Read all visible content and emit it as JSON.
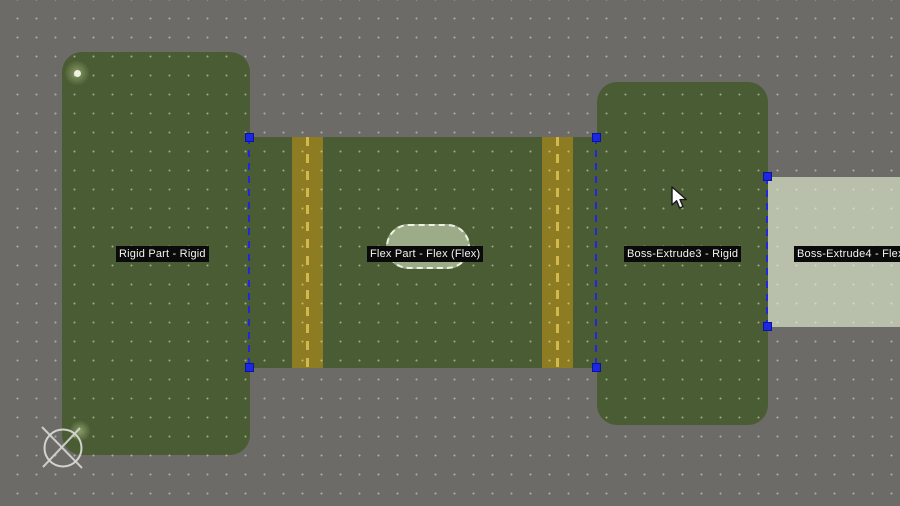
{
  "viewport": {
    "background_color": "#6c6b68",
    "grid_style": "dotted",
    "selection_color": "#2127dc",
    "parts": [
      {
        "label": "Rigid Part - Rigid",
        "fill": "#4a5c33"
      },
      {
        "label": "Flex Part - Flex (Flex)",
        "fill": "#4a5c33",
        "stripe_color": "#8e7c22",
        "stripe_dash_color": "#d2b94f"
      },
      {
        "label": "Boss-Extrude3 - Rigid",
        "fill": "#4a5c33"
      },
      {
        "label": "Boss-Extrude4 - Flex",
        "fill": "#b8bfaa"
      }
    ],
    "highlight": {
      "capsule_fill": "#9dac88",
      "capsule_border": "dashed-white"
    },
    "icons": {
      "origin": "crossed-circle-icon",
      "pointer": "cursor-arrow-icon",
      "vertex": "vertex-point-icon"
    }
  }
}
